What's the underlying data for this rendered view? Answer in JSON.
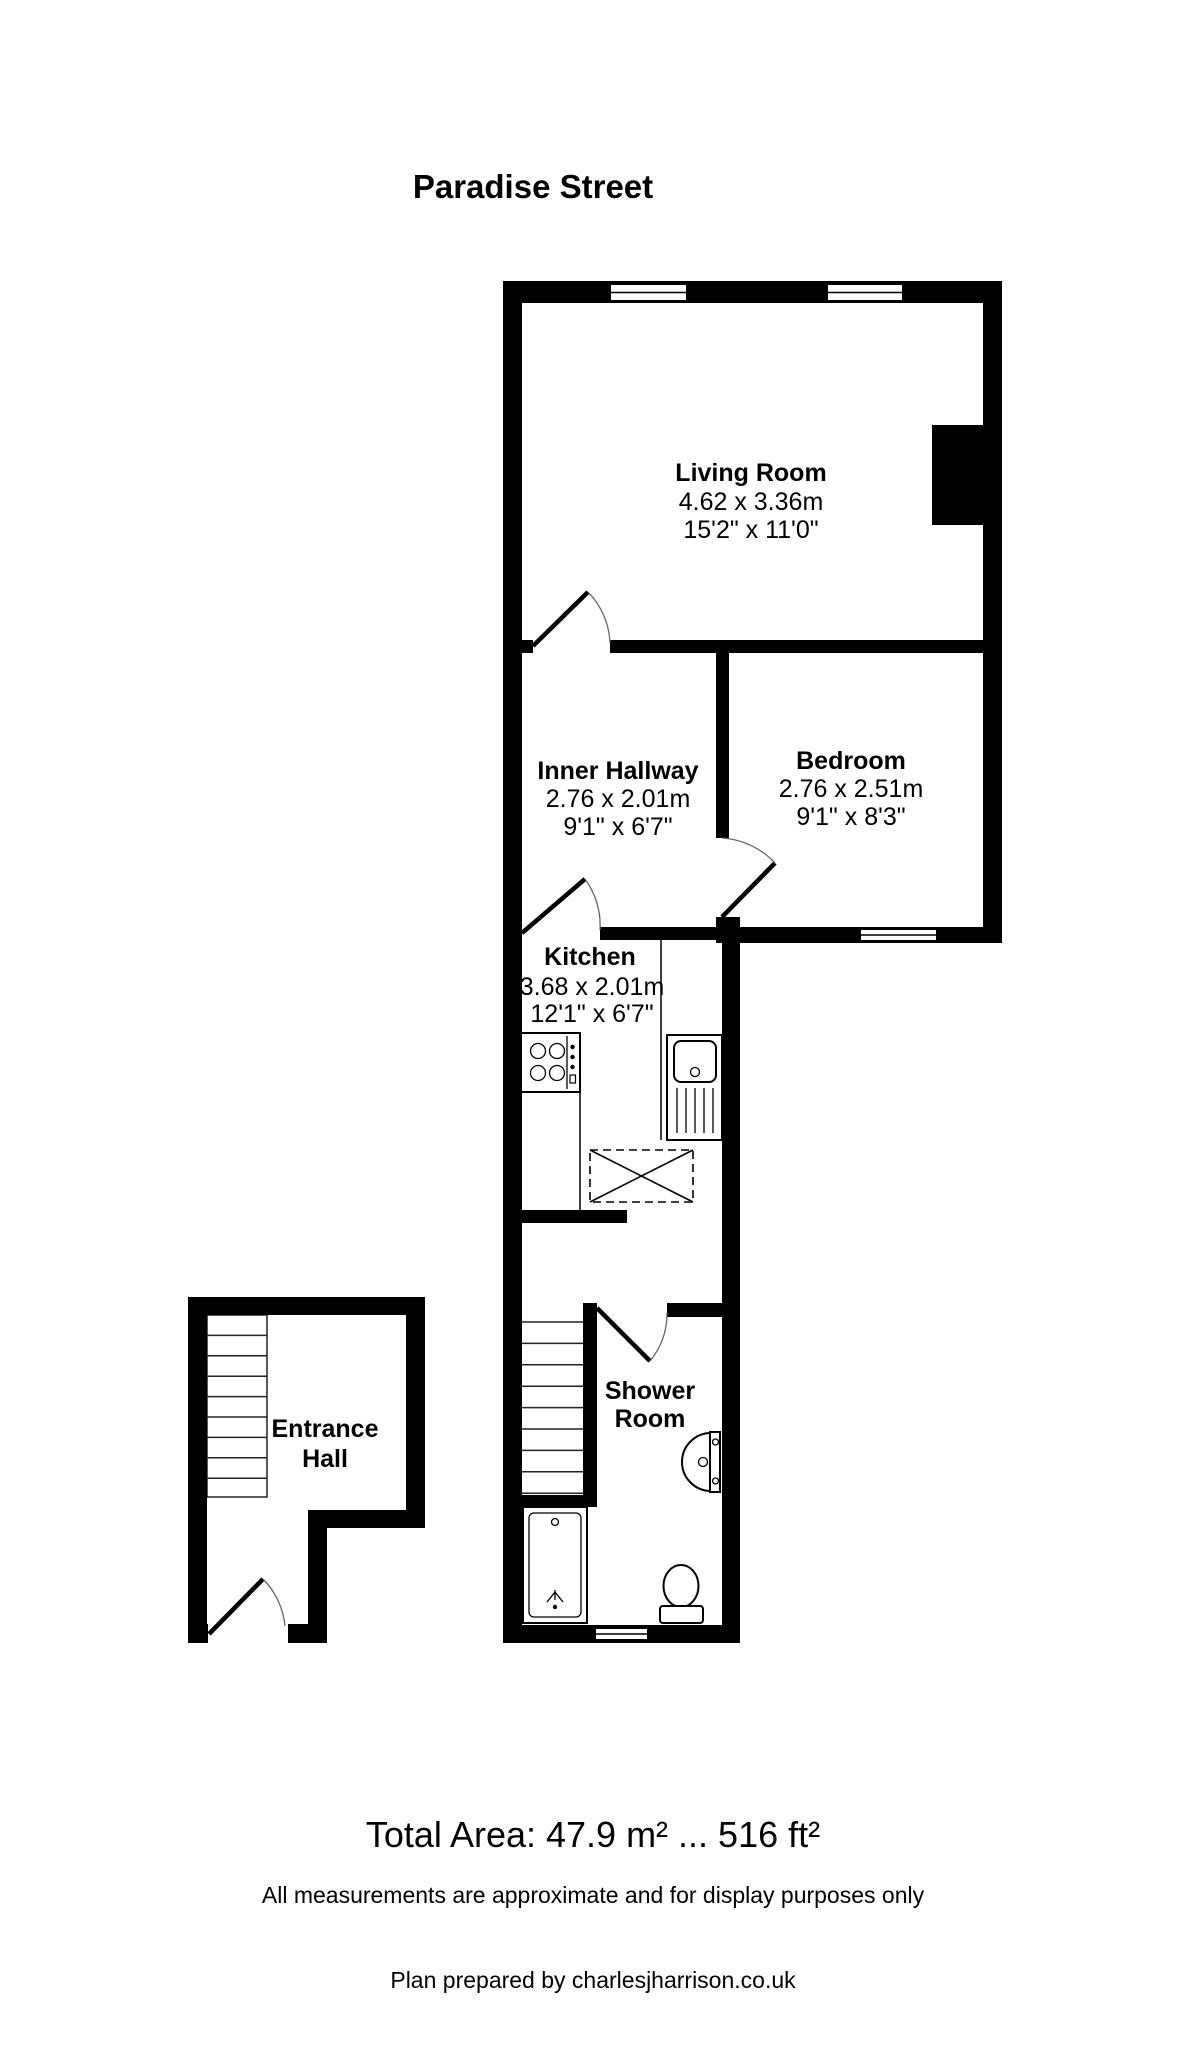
{
  "title": "Paradise Street",
  "rooms": {
    "living": {
      "name": "Living Room",
      "metric": "4.62 x 3.36m",
      "imperial": "15'2\" x 11'0\""
    },
    "hallway": {
      "name": "Inner Hallway",
      "metric": "2.76 x 2.01m",
      "imperial": "9'1\" x 6'7\""
    },
    "bedroom": {
      "name": "Bedroom",
      "metric": "2.76 x 2.51m",
      "imperial": "9'1\" x 8'3\""
    },
    "kitchen": {
      "name": "Kitchen",
      "metric": "3.68 x 2.01m",
      "imperial": "12'1\" x 6'7\""
    },
    "shower": {
      "name_line1": "Shower",
      "name_line2": "Room"
    },
    "entrance": {
      "name_line1": "Entrance",
      "name_line2": "Hall"
    }
  },
  "footer": {
    "total_area": "Total Area: 47.9 m² ... 516 ft²",
    "disclaimer": "All measurements are approximate and for display purposes only",
    "credit": "Plan prepared by charlesjharrison.co.uk"
  },
  "colors": {
    "wall": "#000000",
    "background": "#ffffff",
    "text": "#000000"
  }
}
